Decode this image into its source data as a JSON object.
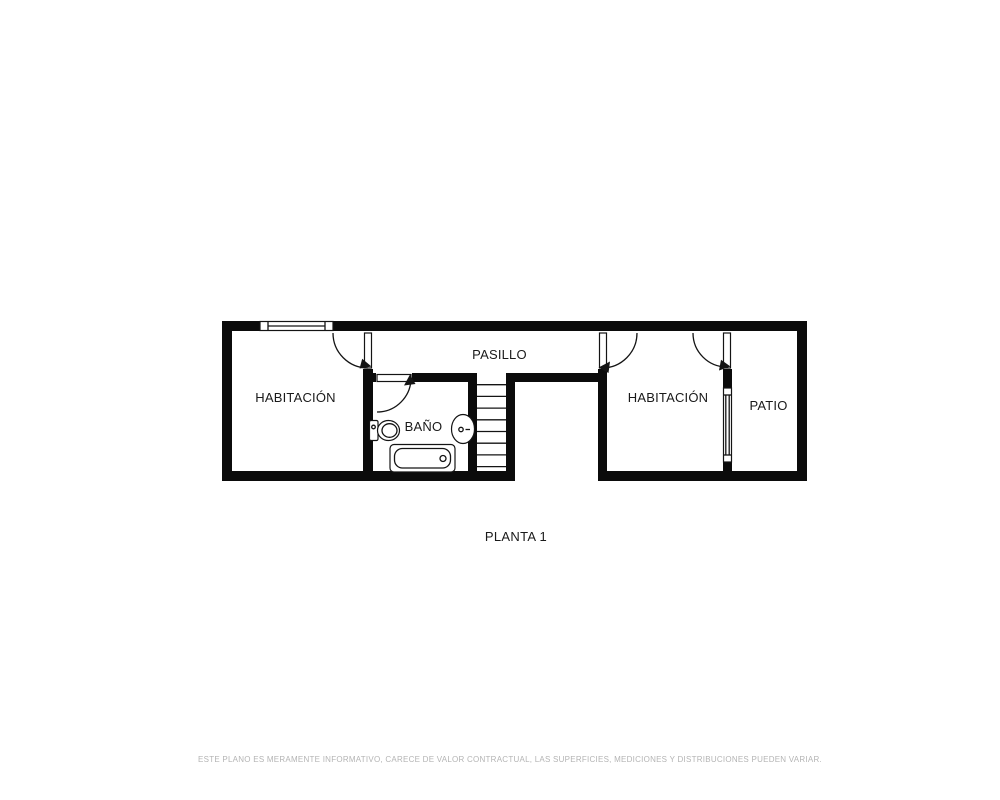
{
  "plan": {
    "floor_label": "PLANTA 1",
    "rooms": {
      "habitacion_left": "HABITACIÓN",
      "pasillo": "PASILLO",
      "bano": "BAÑO",
      "habitacion_right": "HABITACIÓN",
      "patio": "PATIO"
    },
    "disclaimer": "ESTE PLANO ES MERAMENTE INFORMATIVO, CARECE DE VALOR CONTRACTUAL, LAS SUPERFICIES, MEDICIONES Y DISTRIBUCIONES PUEDEN VARIAR.",
    "icons": [
      "window-icon",
      "door-icon",
      "stairs-icon",
      "toilet-icon",
      "sink-icon",
      "bathtub-icon"
    ],
    "colors": {
      "wall": "#0b0b0b",
      "line": "#141414",
      "label_text": "#1a1a1a",
      "disclaimer_text": "#b4b4b4",
      "background": "#ffffff"
    }
  }
}
